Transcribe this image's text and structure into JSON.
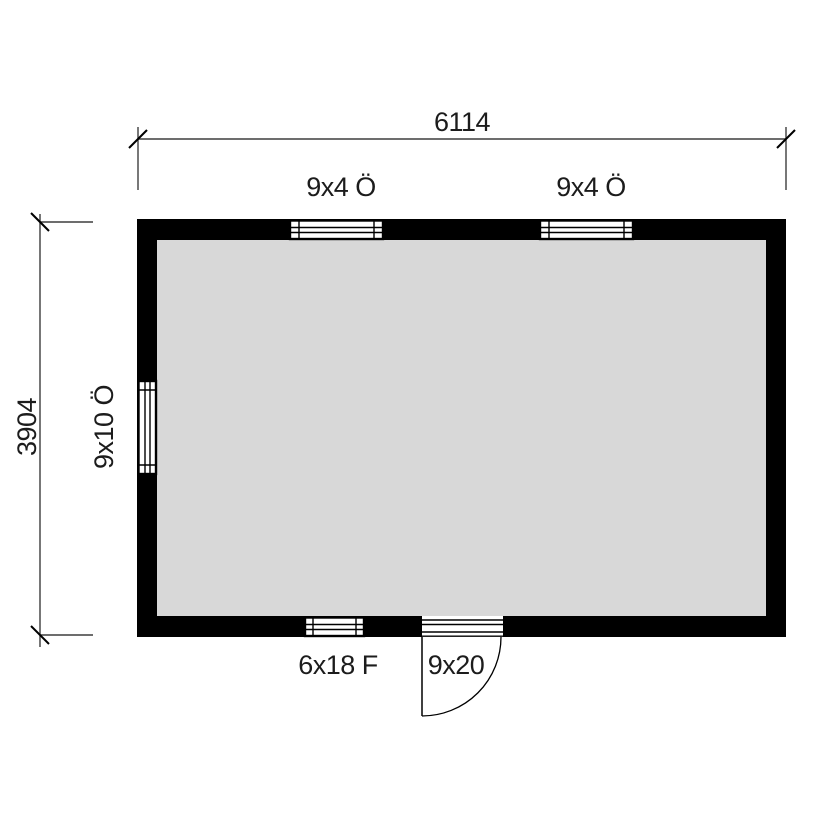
{
  "floor_plan": {
    "dimensions": {
      "width_label": "6114",
      "height_label": "3904"
    },
    "openings": {
      "window_top_left_label": "9x4 Ö",
      "window_top_right_label": "9x4 Ö",
      "window_left_label": "9x10 Ö",
      "window_bottom_label": "6x18 F",
      "door_label": "9x20"
    }
  },
  "colors": {
    "wall": "#000000",
    "floor": "#d8d8d8",
    "dimension_line": "#3d3d3d",
    "tick": "#000000",
    "background": "#ffffff"
  }
}
